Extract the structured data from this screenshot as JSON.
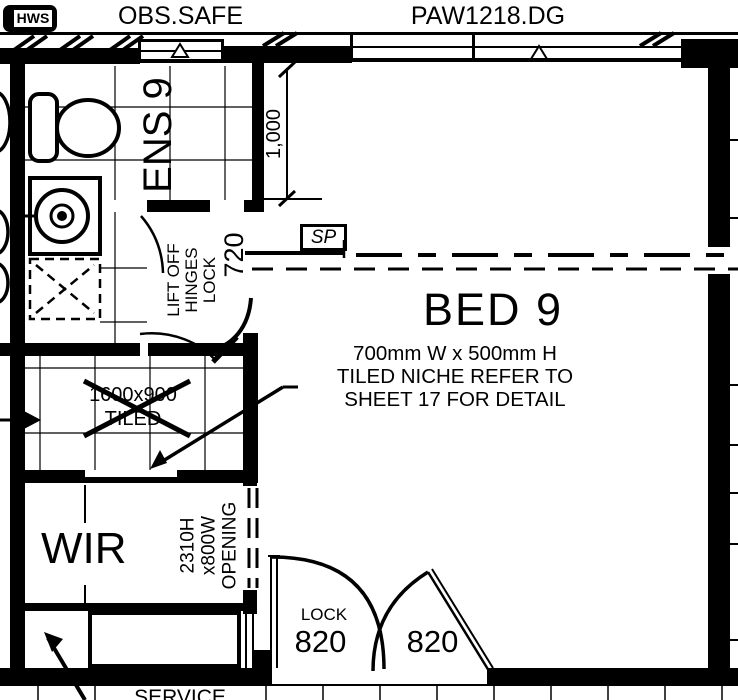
{
  "plan": {
    "equipment": {
      "hws": "HWS"
    },
    "windows": {
      "left": "OBS.SAFE",
      "right": "PAW1218.DG"
    },
    "rooms": {
      "ensuite": "ENS 9",
      "bedroom": "BED 9",
      "robe": "WIR",
      "service": "SERVICE"
    },
    "dimensions": {
      "window_offset": "1,000",
      "ens_door_width": "720",
      "door_left_width": "820",
      "door_right_width": "820"
    },
    "annotations": {
      "smoke_provision": "SP",
      "door_lock": "LOCK",
      "door_note": [
        "LIFT OFF",
        "HINGES",
        "LOCK"
      ],
      "niche_note": [
        "700mm W x 500mm H",
        "TILED NICHE REFER TO",
        "SHEET 17 FOR DETAIL"
      ],
      "shower_note": [
        "1600x900",
        "TILED"
      ],
      "opening_note": [
        "2310H",
        "x800W",
        "OPENING"
      ]
    },
    "colors": {
      "ink": "#000000",
      "paper": "#ffffff"
    }
  }
}
